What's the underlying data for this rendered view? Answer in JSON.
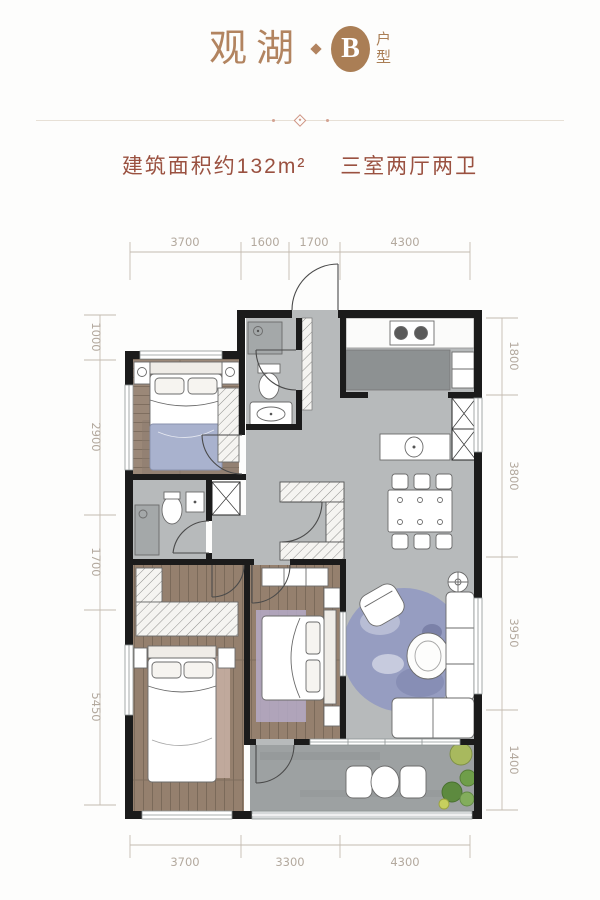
{
  "header": {
    "project_name": "观湖",
    "separator_icon": "diamond-icon",
    "unit_letter": "B",
    "unit_suffix_top": "户",
    "unit_suffix_bottom": "型",
    "accent_color": "#aa7e55"
  },
  "divider": {
    "ornament_icon": "diamond-ornament-icon"
  },
  "summary": {
    "area_text": "建筑面积约132m²",
    "layout_text": "三室两厅两卫",
    "text_color": "#9a5140"
  },
  "floor_plan": {
    "dimension_color": "#b3a99e",
    "wall_color": "#1b1b1b",
    "dimensions": {
      "top": [
        "3700",
        "1600",
        "1700",
        "4300"
      ],
      "bottom": [
        "3700",
        "3300",
        "4300"
      ],
      "left": [
        "1000",
        "2900",
        "1700",
        "5450"
      ],
      "right": [
        "1800",
        "3800",
        "3950",
        "1400"
      ]
    }
  }
}
